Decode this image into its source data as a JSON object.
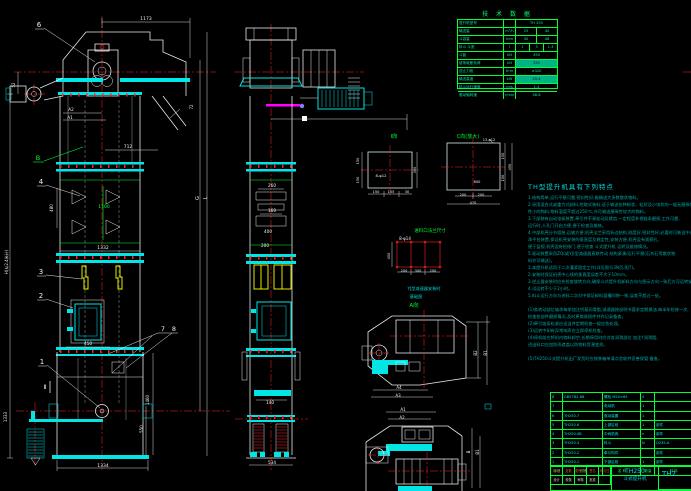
{
  "colors": {
    "w": "#f0f0f0",
    "g": "#00ff33",
    "c": "#00d8d8",
    "y": "#ffff00"
  },
  "tech_table": {
    "title": "技 术 数 据",
    "rows": [
      {
        "label": "提升机型号",
        "unit": "",
        "value": "TH 250"
      },
      {
        "label": "输送量",
        "unit": "m³/h",
        "value": "25|40"
      },
      {
        "label": "斗容量",
        "unit": "mm",
        "value": "30|48"
      },
      {
        "label": "料斗 斗宽",
        "unit": "l",
        "value": "1|3|1.3"
      },
      {
        "label": "斗距",
        "unit": "kN",
        "value": "450"
      },
      {
        "label": "链条破断负荷",
        "unit": "kN",
        "value": "250",
        "solid": true
      },
      {
        "label": "逆止力矩",
        "unit": "N·m",
        "value": "≥320"
      },
      {
        "label": "输送高度",
        "unit": "kW",
        "value": "25.4",
        "solid": true
      },
      {
        "label": "料斗运行速度",
        "unit": "m/s",
        "value": "1.4"
      },
      {
        "label": "驱动轴转速",
        "unit": "r/min",
        "value": "48.8"
      }
    ]
  },
  "notes": {
    "heading": "TH型提升机具有下列特点",
    "lines": [
      "1.结构简单,运行平稳可靠,密封性好,能输送大多数散状物料。",
      "2.采用混合式或重力式卸料,挖取式装料,适于输送各种粉状、粒状及小块状的一般无磨琢性或磨琢",
      "  性小的物料,物料温度不超过250℃,亦可输送磨琢性较大的物料。",
      "3.下部装有自动张紧装置,牵引件不易松动及跳齿,一定程度补偿链条磨损,工作可靠,",
      "  运行时,人孔门开启方便,便于检查及维修。",
      "4.中部机壳分节组装,运输方便;机壳法兰采用折边结构,刚度好,密封性好;必要时可装设中间支",
      "  承平台装置,保证机壳安装的垂直度及稳定性,安装方便,机壳设有观察孔,",
      "  便于监视,机壳设有检修门,便于检查 斗式提升机 运转及维修情况。",
      "5.驱动装置采用ZQ(或YJ)型减速器直联传动                结构紧凑/运行平稳(石灰石等散状物",
      "  料亦可输送)。",
      "1.本提升机适用于二次灌浆固定工作(详见图号3N页,图7)。",
      "2.安装时保证机壳中心线的垂直度误差不大于10mm。",
      "3.逆止器安装时应先检查旋转方向,确保斗式提升机卸料方向与图示方向一致后方可运转安装。",
      "4.试运转不少于2小时。",
      "5.料斗运行方向与进料二次对中保证卸料溜槽间隙一致,误差不超过一处。",
      "",
      "(1)各转动部位轴承每季加注钙基润滑脂,减速器按说明书要求定期换油,每半年检修一次,",
      "   检查各部件磨损情况,及时更换易损件并作记录备查。",
      "(2)牵引链条松紧应适当并定期检查一般应急处理。",
      "(3)运转中如有异常响声应立即停机检查。",
      "(4)停机前应将机内物料卸空,长期停用时应对各润滑部位 加注Y润滑脂,",
      "   进出料口应加防雨遮盖以防物料受潮变质。",
      "",
      "(5)TH250斗式提升机出厂发货时应按装箱单清点验收并妥善保管 备查。"
    ]
  },
  "bom": {
    "headers": [
      "序号",
      "代号",
      "名 称",
      "数量",
      "材 料",
      "备注"
    ],
    "rows": [
      [
        "8",
        "GB5782-86",
        "螺栓 M20×65",
        "4",
        "",
        "标准件"
      ],
      [
        "7",
        "",
        "电动机",
        "1",
        "",
        "配套"
      ],
      [
        "6",
        "TH250.7",
        "驱动装置",
        "1",
        "",
        "部件"
      ],
      [
        "5",
        "TH250.6",
        "上部区段",
        "1",
        "部件",
        ""
      ],
      [
        "4",
        "TH250.4B",
        "中间机壳",
        "n",
        "部件",
        ""
      ],
      [
        "3",
        "TH250.3",
        "料斗",
        "N",
        "Q235-A",
        "204×2"
      ],
      [
        "2",
        "TH250.2",
        "牵引构件",
        "",
        "部件",
        ""
      ],
      [
        "1",
        "TH250.1",
        "下部区段",
        "1",
        "部件",
        ""
      ]
    ]
  },
  "title_block": {
    "model": "TH250",
    "name": "斗式提升机",
    "right_model": "TH2",
    "field_rows": [
      {
        "style": "tb-red",
        "cells": [
          "标记",
          "处数",
          "更改文件号",
          "签名",
          "年月日"
        ]
      },
      {
        "style": "tb-white",
        "cells": [
          "设计",
          "校核",
          "审核",
          "批准",
          ""
        ]
      }
    ]
  },
  "labels": [
    {
      "t": "1173",
      "x": 146,
      "y": 20,
      "c": "w",
      "s": 4.5
    },
    {
      "t": "6",
      "x": 39,
      "y": 27,
      "c": "w",
      "s": 7
    },
    {
      "t": "52",
      "x": 15,
      "y": 85,
      "c": "w",
      "s": 4,
      "r": 1
    },
    {
      "t": "A2",
      "x": 71,
      "y": 111,
      "c": "w",
      "s": 4.2
    },
    {
      "t": "A1",
      "x": 70,
      "y": 119,
      "c": "w",
      "s": 4.2
    },
    {
      "t": "712",
      "x": 128,
      "y": 148,
      "c": "w",
      "s": 4.5
    },
    {
      "t": "B",
      "x": 38,
      "y": 160,
      "c": "g",
      "s": 6.5
    },
    {
      "t": "72",
      "x": 193,
      "y": 107,
      "c": "w",
      "s": 4,
      "r": 1
    },
    {
      "t": "4",
      "x": 41,
      "y": 184,
      "c": "w",
      "s": 7
    },
    {
      "t": "480",
      "x": 53,
      "y": 208,
      "c": "w",
      "s": 4,
      "r": 1
    },
    {
      "t": "1100",
      "x": 104,
      "y": 208,
      "c": "g",
      "s": 4.5
    },
    {
      "t": "1332",
      "x": 103,
      "y": 249,
      "c": "w",
      "s": 4.5
    },
    {
      "t": "H(从2.4米计)",
      "x": 8,
      "y": 262,
      "c": "w",
      "s": 4,
      "r": 1
    },
    {
      "t": "G",
      "x": 199,
      "y": 198,
      "c": "w",
      "s": 5,
      "r": 1
    },
    {
      "t": "L",
      "x": 207,
      "y": 198,
      "c": "w",
      "s": 5,
      "r": 1
    },
    {
      "t": "3",
      "x": 41,
      "y": 274,
      "c": "w",
      "s": 7
    },
    {
      "t": "2",
      "x": 41,
      "y": 298,
      "c": "w",
      "s": 7
    },
    {
      "t": "7",
      "x": 163,
      "y": 331,
      "c": "w",
      "s": 6.5
    },
    {
      "t": "8",
      "x": 174,
      "y": 331,
      "c": "w",
      "s": 6.5
    },
    {
      "t": "450",
      "x": 88,
      "y": 345,
      "c": "w",
      "s": 4.5
    },
    {
      "t": "1",
      "x": 42,
      "y": 364,
      "c": "w",
      "s": 7
    },
    {
      "t": "Ⅱ",
      "x": 45,
      "y": 389,
      "c": "w",
      "s": 6
    },
    {
      "t": "1460",
      "x": 149,
      "y": 400,
      "c": "w",
      "s": 4,
      "r": 1
    },
    {
      "t": "550",
      "x": 143,
      "y": 429,
      "c": "w",
      "s": 4,
      "r": 1
    },
    {
      "t": "1333",
      "x": 7,
      "y": 417,
      "c": "w",
      "s": 4,
      "r": 1
    },
    {
      "t": "1334",
      "x": 103,
      "y": 467,
      "c": "w",
      "s": 4.5
    },
    {
      "t": "260",
      "x": 272,
      "y": 187,
      "c": "w",
      "s": 4.2
    },
    {
      "t": "160",
      "x": 272,
      "y": 212,
      "c": "w",
      "s": 4.2
    },
    {
      "t": "400",
      "x": 268,
      "y": 233,
      "c": "w",
      "s": 4.2
    },
    {
      "t": "200",
      "x": 265,
      "y": 247,
      "c": "w",
      "s": 4.2
    },
    {
      "t": "140",
      "x": 270,
      "y": 404,
      "c": "w",
      "s": 4.2
    },
    {
      "t": "534",
      "x": 272,
      "y": 464,
      "c": "w",
      "s": 4.2
    },
    {
      "t": "I向",
      "x": 394,
      "y": 138,
      "c": "g",
      "s": 5.5
    },
    {
      "t": "8-φ12",
      "x": 381,
      "y": 177,
      "c": "w",
      "s": 3.8
    },
    {
      "t": "150",
      "x": 359,
      "y": 161,
      "c": "w",
      "s": 3.5,
      "r": 1
    },
    {
      "t": "150",
      "x": 359,
      "y": 180,
      "c": "w",
      "s": 3.5,
      "r": 1
    },
    {
      "t": "300",
      "x": 416,
      "y": 170,
      "c": "w",
      "s": 3.5,
      "r": 1
    },
    {
      "t": "150",
      "x": 376,
      "y": 193,
      "c": "w",
      "s": 3.5
    },
    {
      "t": "155",
      "x": 391,
      "y": 193,
      "c": "w",
      "s": 3.5
    },
    {
      "t": "30",
      "x": 407,
      "y": 193,
      "c": "w",
      "s": 3.5
    },
    {
      "t": "C向(放大)",
      "x": 468,
      "y": 138,
      "c": "g",
      "s": 5
    },
    {
      "t": "13-φ12",
      "x": 489,
      "y": 141,
      "c": "w",
      "s": 3.5
    },
    {
      "t": "600",
      "x": 477,
      "y": 183,
      "c": "w",
      "s": 3.5
    },
    {
      "t": "200",
      "x": 463,
      "y": 196,
      "c": "w",
      "s": 3.5
    },
    {
      "t": "200",
      "x": 481,
      "y": 196,
      "c": "w",
      "s": 3.5
    },
    {
      "t": "470",
      "x": 473,
      "y": 204,
      "c": "w",
      "s": 3.5
    },
    {
      "t": "150",
      "x": 504,
      "y": 156,
      "c": "w",
      "s": 3.5,
      "r": 1
    },
    {
      "t": "150",
      "x": 504,
      "y": 178,
      "c": "w",
      "s": 3.5,
      "r": 1
    },
    {
      "t": "450",
      "x": 511,
      "y": 167,
      "c": "w",
      "s": 3.5,
      "r": 1
    },
    {
      "t": "8-φ14",
      "x": 405,
      "y": 240,
      "c": "w",
      "s": 4
    },
    {
      "t": "450",
      "x": 390,
      "y": 256,
      "c": "w",
      "s": 3.5,
      "r": 1
    },
    {
      "t": "200",
      "x": 404,
      "y": 272,
      "c": "w",
      "s": 3.5
    },
    {
      "t": "300",
      "x": 418,
      "y": 272,
      "c": "w",
      "s": 3.5
    },
    {
      "t": "200",
      "x": 433,
      "y": 272,
      "c": "w",
      "s": 3.5
    },
    {
      "t": "进料口法兰尺寸",
      "x": 430,
      "y": 232,
      "c": "g",
      "s": 4.5
    },
    {
      "t": "YJ型减速器安装时",
      "x": 424,
      "y": 290,
      "c": "c",
      "s": 4.2
    },
    {
      "t": "基础图",
      "x": 416,
      "y": 298,
      "c": "c",
      "s": 4.2
    },
    {
      "t": "A向",
      "x": 414,
      "y": 307,
      "c": "g",
      "s": 5.5
    },
    {
      "t": "A4",
      "x": 399,
      "y": 389,
      "c": "w",
      "s": 4
    },
    {
      "t": "A3",
      "x": 398,
      "y": 397,
      "c": "w",
      "s": 4
    },
    {
      "t": "B2",
      "x": 477,
      "y": 353,
      "c": "w",
      "s": 4,
      "r": 1
    },
    {
      "t": "B1",
      "x": 487,
      "y": 353,
      "c": "w",
      "s": 4,
      "r": 1
    },
    {
      "t": "A1",
      "x": 403,
      "y": 411,
      "c": "w",
      "s": 4
    },
    {
      "t": "A2",
      "x": 402,
      "y": 419,
      "c": "w",
      "s": 4
    },
    {
      "t": "B",
      "x": 470,
      "y": 452,
      "c": "w",
      "s": 4,
      "r": 1
    },
    {
      "t": "B1",
      "x": 479,
      "y": 452,
      "c": "w",
      "s": 4,
      "r": 1
    }
  ]
}
